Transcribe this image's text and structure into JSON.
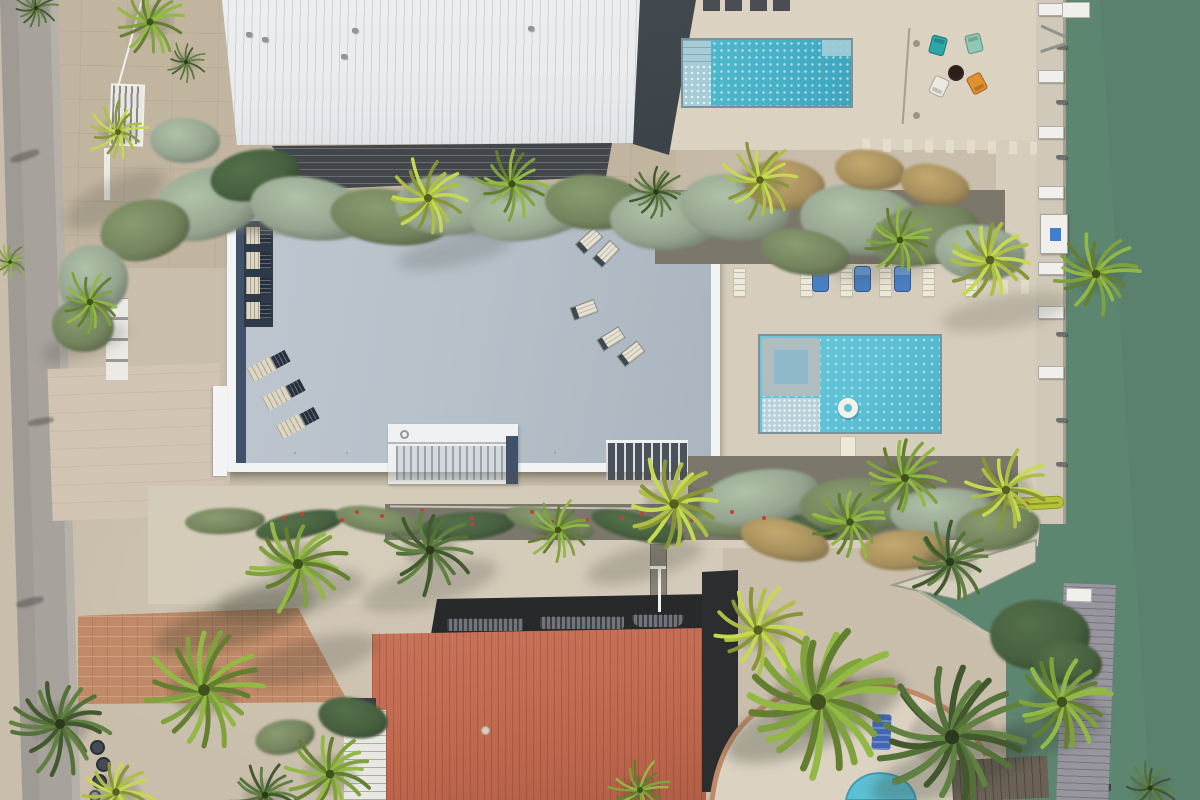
{
  "description": "Aerial top-down drone photo of waterfront homes: white metal-roof house, flat gray-roof house with rooftop loungers, red metal-roof house, two turquoise pools, fire-pit with four Adirondack chairs, green canal with seawall, docks and palm trees",
  "palette": {
    "road": "#a7a39c",
    "road_light": "#b5b1a9",
    "sand": "#c9bdab",
    "sand_dark": "#c2b5a0",
    "deck_cream": "#dbd2c2",
    "deck_light": "#d7cdbd",
    "paver_pink": "#d1c4b2",
    "concrete_walk": "#d6ccbb",
    "water": "#5d8671",
    "water_deep": "#567d69",
    "seawall": "#d0c8b8",
    "seawall_edge": "#a99f8e",
    "ramp": "#d6cebe",
    "white_roof": "#e8eaec",
    "white_roof_rib": "rgba(165,173,180,0.40)",
    "dark_roof": "#3b4248",
    "balcony": "#43474b",
    "roof_gray": "#b7c1ca",
    "roof_gray_dark": "#aab5bf",
    "roof_white": "#f2f3f4",
    "roof_navy": "#42516a",
    "lounger_bay": "#2f3a48",
    "lounger_dark": "#27313d",
    "lounger_tan": "#ddd6c3",
    "lounger_cream": "#e6e1d2",
    "stair_white": "#eff0f1",
    "stair_rail": "#9aa3ab",
    "stair_dark": "#4a525c",
    "pool_edge": "#7d9199",
    "pool1": "#47b1c7",
    "pool_ledge": "#a5ccd7",
    "pool2": "#5cc0d4",
    "spa_deck": "#b1bcbf",
    "spa_water": "#8fb9c9",
    "float": "#f1f0e9",
    "red_roof": "#c0694f",
    "red_rib": "rgba(90,35,22,0.22)",
    "shadow_band": "#28292b",
    "vent": "#71747a",
    "vent_slat": "rgba(20,22,24,0.55)",
    "brick": "#c08a68",
    "wood_dock": "#97969f",
    "wood_plank": "rgba(60,58,70,0.35)",
    "wood_dark": "#6b6156",
    "chair_white": "#ece8da",
    "chair_blue": "#4a7ec2",
    "lounger_blue": "#4066b4",
    "adir_teal": "#2ea6a9",
    "adir_mint": "#8fc8b5",
    "adir_white": "#ebe9e0",
    "adir_orange": "#e0912f",
    "firepit": "#46322a",
    "firepit_dark": "#2c1f19",
    "sage": "#95a48f",
    "olive": "#74845e",
    "darkgreen": "#47603f",
    "grass": "#a68f5d",
    "gravel": "#8a8478",
    "gravel_dark": "#7b776b",
    "palm_green": "#7fa23c",
    "palm_bright": "#aebf45",
    "palm_dark": "#55713a",
    "kayak": "#b5c23a",
    "kayak_line": "#8b9a26",
    "kayak_red": "#c23c2c",
    "flower": "#c14038",
    "bin": "#454b54",
    "bin_light": "#9aa0a2",
    "white": "#f0efec",
    "speck": "#8e959b"
  },
  "scene": {
    "pergola_squares": [
      [
        703,
        0
      ],
      [
        725,
        0
      ],
      [
        750,
        0
      ],
      [
        773,
        0
      ]
    ],
    "roof_specks": [
      [
        246,
        32
      ],
      [
        262,
        37
      ],
      [
        352,
        28
      ],
      [
        341,
        54
      ],
      [
        528,
        26
      ]
    ],
    "road_patches": [
      [
        10,
        152,
        30,
        8,
        -18
      ],
      [
        28,
        418,
        26,
        7,
        -10
      ],
      [
        16,
        598,
        28,
        8,
        -14
      ]
    ],
    "dock_boxes_y": [
      3,
      70,
      126,
      186,
      262,
      306,
      366
    ],
    "cleats_y": [
      45,
      100,
      155,
      240,
      332,
      418,
      462
    ],
    "dock_posts_y": [
      595,
      640,
      688,
      736,
      784
    ],
    "lift_beams": [
      [
        1040,
        30,
        24
      ],
      [
        1040,
        46,
        -18
      ]
    ],
    "roof_loungers_stack": [
      [
        246,
        227
      ],
      [
        246,
        252
      ],
      [
        246,
        277
      ],
      [
        246,
        302
      ]
    ],
    "roof_loungers_mid": [
      [
        248,
        358,
        -28
      ],
      [
        263,
        387,
        -28
      ],
      [
        277,
        415,
        -28
      ]
    ],
    "roof_loungers_tan": [
      [
        576,
        234,
        -42
      ],
      [
        593,
        247,
        -46
      ],
      [
        571,
        303,
        -20
      ],
      [
        598,
        332,
        -32
      ],
      [
        618,
        347,
        -38
      ]
    ],
    "row_white_x": [
      733,
      800,
      840,
      879,
      922,
      965
    ],
    "row_blue_x": [
      812,
      854,
      894
    ],
    "adirondacks": [
      [
        930,
        36,
        15,
        "adir_teal"
      ],
      [
        966,
        34,
        -14,
        "adir_mint"
      ],
      [
        931,
        77,
        205,
        "adir_white"
      ],
      [
        969,
        74,
        152,
        "adir_orange"
      ]
    ],
    "deck_dots": [
      [
        913,
        40
      ],
      [
        913,
        112
      ]
    ],
    "dash_rows": [
      [
        862,
        140,
        175,
        13,
        1
      ],
      [
        1000,
        280,
        40,
        14,
        0
      ]
    ],
    "vents": [
      [
        447,
        618,
        76,
        13,
        3
      ],
      [
        540,
        616,
        84,
        13,
        3
      ],
      [
        632,
        614,
        52,
        13,
        10
      ]
    ],
    "bins": [
      [
        90,
        740,
        15,
        "bin"
      ],
      [
        96,
        757,
        15,
        "bin"
      ],
      [
        92,
        774,
        15,
        "bin"
      ],
      [
        89,
        790,
        12,
        "bin_light"
      ]
    ],
    "gravel_strips": [
      [
        655,
        190,
        350,
        74
      ],
      [
        385,
        504,
        605,
        36
      ],
      [
        688,
        456,
        330,
        82
      ]
    ],
    "soft_gravel": [
      [
        170,
        192,
        430,
        44
      ]
    ],
    "pipes": [
      [
        390,
        508,
        595,
        0.7
      ]
    ],
    "bushes": [
      [
        150,
        168,
        120,
        70,
        "sage"
      ],
      [
        100,
        200,
        90,
        60,
        "olive"
      ],
      [
        210,
        150,
        90,
        50,
        "darkgreen"
      ],
      [
        250,
        178,
        120,
        62,
        "sage"
      ],
      [
        330,
        190,
        120,
        55,
        "olive"
      ],
      [
        395,
        175,
        110,
        60,
        "sage"
      ],
      [
        470,
        185,
        120,
        55,
        "sage"
      ],
      [
        545,
        175,
        100,
        55,
        "olive"
      ],
      [
        610,
        190,
        110,
        60,
        "sage"
      ],
      [
        680,
        175,
        110,
        65,
        "sage"
      ],
      [
        745,
        160,
        80,
        50,
        "grass"
      ],
      [
        800,
        185,
        120,
        70,
        "sage"
      ],
      [
        870,
        205,
        110,
        60,
        "olive"
      ],
      [
        935,
        225,
        90,
        55,
        "sage"
      ],
      [
        835,
        150,
        70,
        40,
        "grass"
      ],
      [
        760,
        230,
        90,
        45,
        "olive"
      ],
      [
        900,
        165,
        70,
        40,
        "grass"
      ],
      [
        58,
        245,
        70,
        70,
        "sage"
      ],
      [
        52,
        300,
        62,
        52,
        "olive"
      ],
      [
        150,
        118,
        70,
        45,
        "sage"
      ],
      [
        185,
        508,
        80,
        26,
        "olive"
      ],
      [
        255,
        512,
        90,
        26,
        "darkgreen"
      ],
      [
        335,
        508,
        90,
        26,
        "olive"
      ],
      [
        420,
        512,
        95,
        28,
        "darkgreen"
      ],
      [
        505,
        510,
        90,
        26,
        "olive"
      ],
      [
        590,
        514,
        95,
        26,
        "darkgreen"
      ],
      [
        670,
        510,
        90,
        26,
        "olive"
      ],
      [
        748,
        514,
        90,
        26,
        "darkgreen"
      ],
      [
        700,
        470,
        120,
        55,
        "sage"
      ],
      [
        800,
        478,
        120,
        55,
        "olive"
      ],
      [
        890,
        488,
        110,
        50,
        "sage"
      ],
      [
        955,
        505,
        85,
        45,
        "olive"
      ],
      [
        740,
        520,
        90,
        40,
        "grass"
      ],
      [
        860,
        530,
        90,
        40,
        "grass"
      ],
      [
        990,
        600,
        100,
        70,
        "darkgreen"
      ],
      [
        1032,
        640,
        70,
        45,
        "darkgreen"
      ],
      [
        318,
        698,
        70,
        40,
        "darkgreen"
      ],
      [
        255,
        720,
        60,
        34,
        "olive"
      ]
    ],
    "flowers": [
      [
        300,
        512
      ],
      [
        340,
        518
      ],
      [
        420,
        508
      ],
      [
        470,
        516
      ],
      [
        530,
        510
      ],
      [
        585,
        518
      ],
      [
        640,
        512
      ],
      [
        690,
        518
      ],
      [
        730,
        510
      ],
      [
        762,
        516
      ],
      [
        470,
        522
      ],
      [
        380,
        514
      ],
      [
        550,
        520
      ],
      [
        620,
        516
      ],
      [
        282,
        516
      ],
      [
        355,
        510
      ]
    ],
    "shadows": [
      [
        150,
        598,
        170,
        46,
        -18,
        0.28
      ],
      [
        215,
        575,
        150,
        40,
        -12,
        0.25
      ],
      [
        360,
        565,
        140,
        40,
        -15,
        0.22
      ],
      [
        585,
        545,
        120,
        34,
        -15,
        0.22
      ],
      [
        720,
        688,
        190,
        60,
        -22,
        0.3
      ],
      [
        868,
        742,
        170,
        52,
        -18,
        0.28
      ],
      [
        990,
        712,
        120,
        40,
        -15,
        0.25
      ],
      [
        40,
        330,
        90,
        26,
        -18,
        0.2
      ],
      [
        940,
        295,
        130,
        34,
        -10,
        0.18
      ],
      [
        830,
        250,
        110,
        30,
        -10,
        0.16
      ],
      [
        60,
        180,
        110,
        40,
        -25,
        0.2
      ],
      [
        240,
        640,
        140,
        40,
        -15,
        0.22
      ],
      [
        395,
        236,
        120,
        30,
        -12,
        0.18
      ]
    ],
    "palms": [
      [
        150,
        22,
        36,
        "palm_green"
      ],
      [
        36,
        8,
        22,
        "palm_dark"
      ],
      [
        186,
        62,
        20,
        "palm_dark"
      ],
      [
        118,
        132,
        30,
        "palm_bright"
      ],
      [
        10,
        262,
        18,
        "palm_green"
      ],
      [
        90,
        302,
        32,
        "palm_green"
      ],
      [
        428,
        198,
        40,
        "palm_bright"
      ],
      [
        512,
        184,
        36,
        "palm_green"
      ],
      [
        656,
        192,
        28,
        "palm_dark"
      ],
      [
        760,
        180,
        38,
        "palm_bright"
      ],
      [
        900,
        240,
        34,
        "palm_green"
      ],
      [
        990,
        260,
        44,
        "palm_bright"
      ],
      [
        1096,
        274,
        42,
        "palm_green"
      ],
      [
        298,
        564,
        50,
        "palm_green"
      ],
      [
        430,
        550,
        44,
        "palm_dark"
      ],
      [
        558,
        530,
        32,
        "palm_green"
      ],
      [
        674,
        504,
        48,
        "palm_bright"
      ],
      [
        850,
        522,
        38,
        "palm_green"
      ],
      [
        950,
        562,
        42,
        "palm_dark"
      ],
      [
        1006,
        490,
        42,
        "palm_bright"
      ],
      [
        905,
        478,
        40,
        "palm_green"
      ],
      [
        204,
        690,
        58,
        "palm_green"
      ],
      [
        60,
        724,
        50,
        "palm_dark"
      ],
      [
        330,
        774,
        44,
        "palm_green"
      ],
      [
        116,
        792,
        38,
        "palm_bright"
      ],
      [
        818,
        702,
        80,
        "palm_green"
      ],
      [
        952,
        737,
        72,
        "palm_dark"
      ],
      [
        1062,
        702,
        52,
        "palm_green"
      ],
      [
        758,
        630,
        46,
        "palm_bright"
      ],
      [
        640,
        790,
        30,
        "palm_green"
      ],
      [
        265,
        795,
        34,
        "palm_dark"
      ],
      [
        1150,
        788,
        26,
        "palm_dark"
      ]
    ]
  }
}
